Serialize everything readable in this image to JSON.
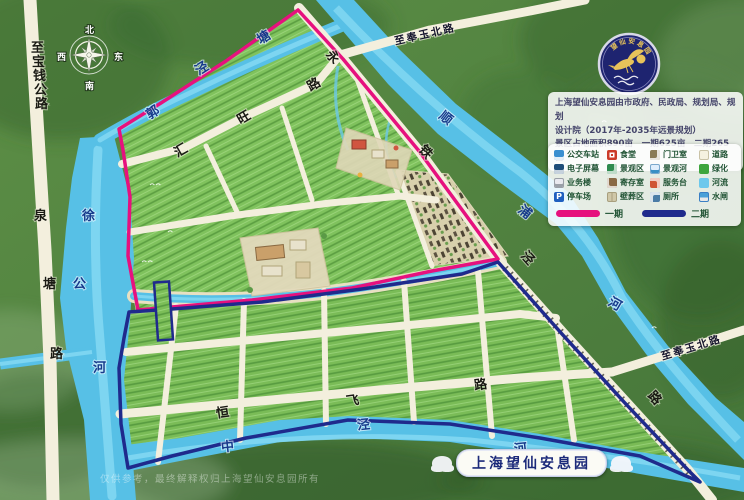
{
  "title": "上海望仙安息园导览图",
  "emblem": {
    "arc_text": "望仙安息园"
  },
  "info_panel": {
    "line1": "上海望仙安息园由市政府、民政局、规划局、规划",
    "line2": "设计院（2017年-2035年远景规划）",
    "line3": "景区占地面积890亩　一期625亩　二期265亩"
  },
  "legend": {
    "items": [
      {
        "label": "公交车站",
        "icon": "bus-station-icon",
        "color": "#3a8fd0"
      },
      {
        "label": "食堂",
        "icon": "canteen-icon",
        "color": "#cc3b2a"
      },
      {
        "label": "门卫室",
        "icon": "guard-room-icon",
        "color": "#8a7a55"
      },
      {
        "label": "道路",
        "icon": "road-swatch",
        "color": "#f5f1e0"
      },
      {
        "label": "电子屏幕",
        "icon": "screen-icon",
        "color": "#1f4e79"
      },
      {
        "label": "景观区",
        "icon": "scenic-area-icon",
        "color": "#2e8b4f"
      },
      {
        "label": "景观河",
        "icon": "scenic-river-icon",
        "color": "#3a8fc4"
      },
      {
        "label": "绿化",
        "icon": "greenery-swatch",
        "color": "#3da53d"
      },
      {
        "label": "业务楼",
        "icon": "office-building-icon",
        "color": "#9aa0a8"
      },
      {
        "label": "寄存室",
        "icon": "storage-room-icon",
        "color": "#8a6a45"
      },
      {
        "label": "服务台",
        "icon": "service-desk-icon",
        "color": "#d05535"
      },
      {
        "label": "河流",
        "icon": "river-swatch",
        "color": "#6cc8ec"
      },
      {
        "label": "停车场",
        "icon": "parking-icon",
        "color": "#1f5fc0"
      },
      {
        "label": "壁葬区",
        "icon": "wall-burial-icon",
        "color": "#cfc7a8"
      },
      {
        "label": "厕所",
        "icon": "toilet-icon",
        "color": "#4a7ba6"
      },
      {
        "label": "水闸",
        "icon": "sluice-icon",
        "color": "#3a7fc4"
      }
    ],
    "phase1": {
      "label": "一期",
      "color": "#e6117e"
    },
    "phase2": {
      "label": "二期",
      "color": "#1f2a8c"
    }
  },
  "banner": {
    "title": "上海望仙安息园"
  },
  "watermark": {
    "text": "仅供参考，最终解释权归上海望仙安息园所有"
  },
  "compass": {
    "north": "北",
    "east": "东",
    "south": "南",
    "west": "西"
  },
  "map": {
    "colors": {
      "river": "#57c0e6",
      "road": "#f3efdd",
      "plots_green": "#7fc05c",
      "phase1_line": "#e6117e",
      "phase2_line": "#1f2a8c",
      "forest": "#4d7c3f"
    },
    "labels": [
      {
        "t": "至"
      },
      {
        "t": "宝"
      },
      {
        "t": "钱"
      },
      {
        "t": "公"
      },
      {
        "t": "路"
      },
      {
        "t": "泉"
      },
      {
        "t": "塘"
      },
      {
        "t": "路"
      },
      {
        "t": "徐"
      },
      {
        "t": "公"
      },
      {
        "t": "河"
      },
      {
        "t": "郭"
      },
      {
        "t": "泾"
      },
      {
        "t": "塘"
      },
      {
        "t": "汇"
      },
      {
        "t": "旺"
      },
      {
        "t": "路"
      },
      {
        "t": "永"
      },
      {
        "t": "铁"
      },
      {
        "t": "泾"
      },
      {
        "t": "路"
      },
      {
        "t": "顺"
      },
      {
        "t": "浦"
      },
      {
        "t": "河"
      },
      {
        "t": "至奉玉北路"
      },
      {
        "t": "至奉玉北路"
      },
      {
        "t": "恒"
      },
      {
        "t": "飞"
      },
      {
        "t": "路"
      },
      {
        "t": "中"
      },
      {
        "t": "泾"
      },
      {
        "t": "河"
      }
    ]
  }
}
